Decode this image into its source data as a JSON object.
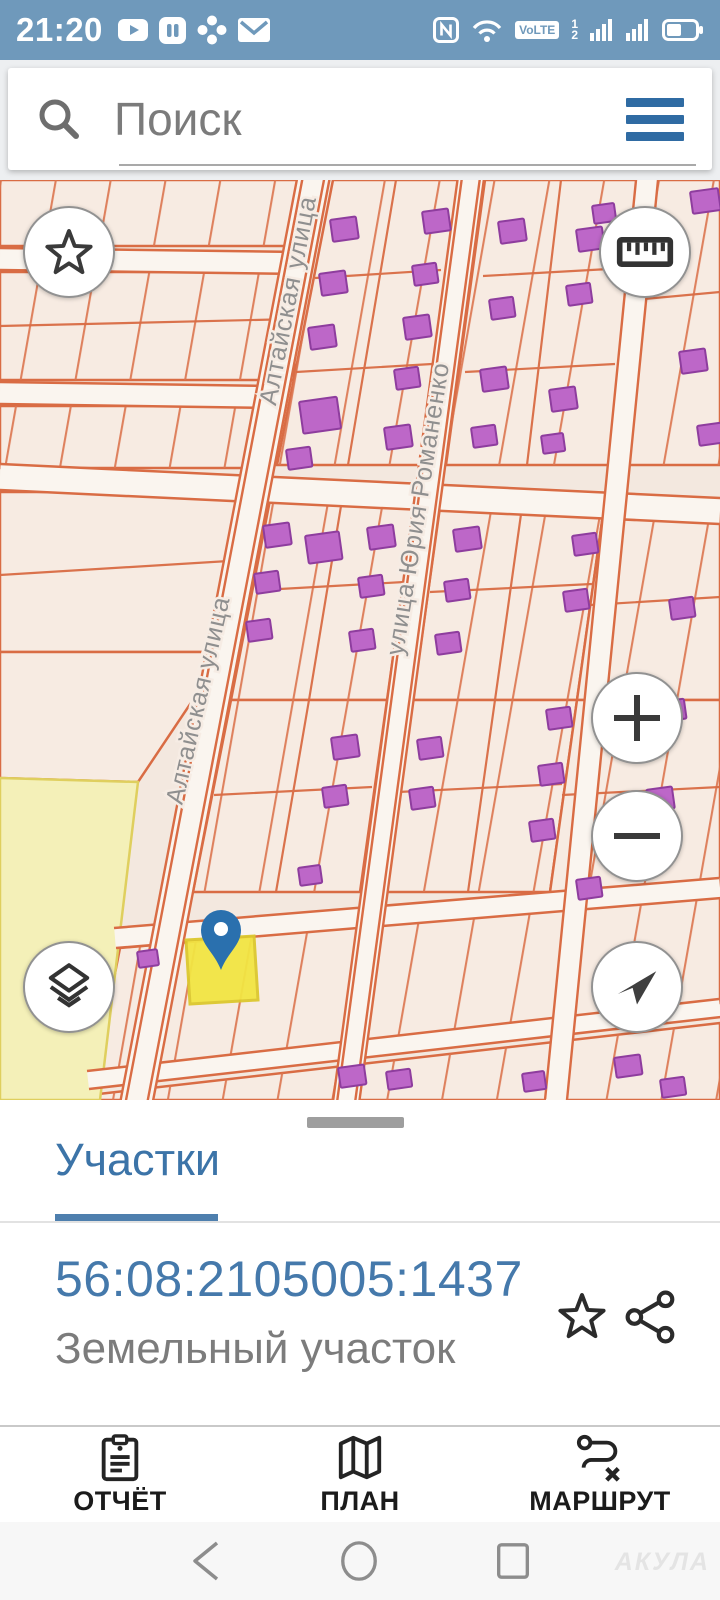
{
  "status_bar": {
    "time": "21:20",
    "nfc_label": "N",
    "volte_label": "VoLTE",
    "sim1": "1",
    "sim2": "2",
    "left_icons": [
      "youtube-icon",
      "gallery-icon",
      "fan-icon",
      "mail-icon"
    ],
    "right_icons": [
      "nfc-icon",
      "wifi-icon",
      "volte-badge",
      "sim-indicators",
      "signal-icon",
      "signal-icon-2",
      "battery-icon"
    ]
  },
  "search": {
    "placeholder": "Поиск"
  },
  "map": {
    "streets": {
      "altayskaya": "Алтайская улица",
      "romanenko": "улица Юрия Романенко"
    },
    "controls": {
      "favorites": "star",
      "measure": "ruler",
      "zoom_in": "+",
      "zoom_out": "−",
      "locate": "arrow",
      "layers": "layers"
    }
  },
  "bottom_sheet": {
    "tab_label": "Участки",
    "cadastral_number": "56:08:2105005:1437",
    "type_label": "Земельный участок"
  },
  "toolbar": {
    "items": [
      {
        "id": "report",
        "label": "ОТЧЁТ"
      },
      {
        "id": "plan",
        "label": "ПЛАН"
      },
      {
        "id": "route",
        "label": "МАРШРУТ"
      }
    ]
  },
  "navigation": {
    "watermark": "АКУЛА"
  },
  "colors": {
    "status_bar": "#6f99bb",
    "accent_blue": "#3c73a6",
    "map_background": "#f3e8df",
    "map_line": "#d96c44",
    "building_fill": "#bd67c8",
    "building_stroke": "#8e3d9e",
    "zone_yellow": "#f4f0b8",
    "selected_parcel": "#f2e543",
    "pin_blue": "#2a70ae"
  }
}
